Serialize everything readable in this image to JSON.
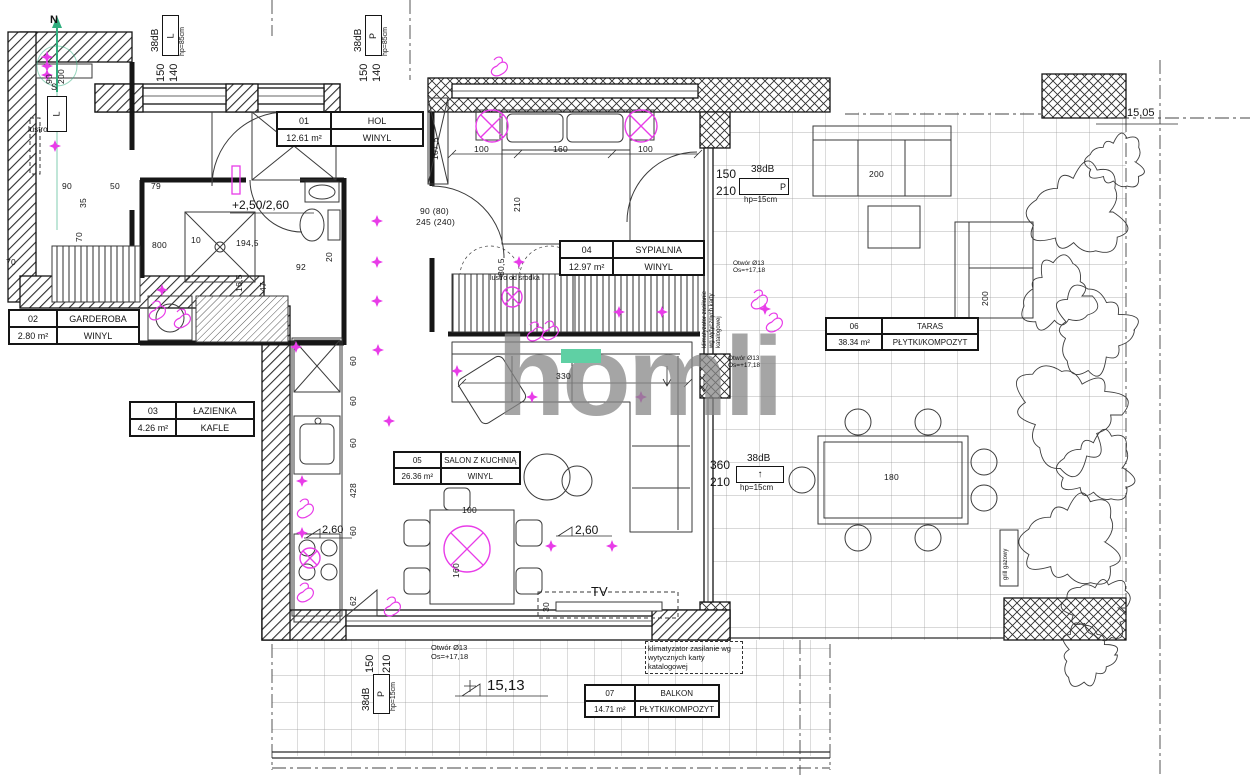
{
  "watermark": {
    "text": "homli",
    "accent_color": "#5fd0a4"
  },
  "rooms": [
    {
      "number": "01",
      "name": "HOL",
      "area": "12.61 m²",
      "floor": "WINYL"
    },
    {
      "number": "02",
      "name": "GARDEROBA",
      "area": "2.80 m²",
      "floor": "WINYL"
    },
    {
      "number": "03",
      "name": "ŁAZIENKA",
      "area": "4.26 m²",
      "floor": "KAFLE"
    },
    {
      "number": "04",
      "name": "SYPIALNIA",
      "area": "12.97 m²",
      "floor": "WINYL"
    },
    {
      "number": "05",
      "name": "SALON Z KUCHNIĄ",
      "area": "26.36 m²",
      "floor": "WINYL"
    },
    {
      "number": "06",
      "name": "TARAS",
      "area": "38.34 m²",
      "floor": "PŁYTKI/KOMPOZYT"
    },
    {
      "number": "07",
      "name": "BALKON",
      "area": "14.71 m²",
      "floor": "PŁYTKI/KOMPOZYT"
    }
  ],
  "windows": [
    {
      "w": "150",
      "h": "140",
      "db": "38dB",
      "tag": "L",
      "hp": "hp=85cm"
    },
    {
      "w": "150",
      "h": "140",
      "db": "38dB",
      "tag": "P",
      "hp": "hp=85cm"
    },
    {
      "w": "150",
      "h": "210",
      "db": "38dB",
      "tag": "P",
      "hp": "hp=15cm"
    },
    {
      "w": "360",
      "h": "210",
      "db": "38dB",
      "tag": "↑",
      "hp": "hp=15cm"
    },
    {
      "w": "150",
      "h": "210",
      "db": "38dB",
      "tag": "P",
      "hp": "hp=15cm"
    }
  ],
  "annotations": {
    "north": "N",
    "south": "S",
    "switch_l": "L",
    "lustro": "lustro",
    "lustro_od_srodka": "lustro od środka",
    "level_bath": "+2,50/2,60",
    "level_kitchen": "2,60",
    "level_salon": "2,60",
    "level_balkon": "15,13",
    "level_taras": "15,05",
    "otwor": "Otwór Ø13",
    "otwor_os": "Os=+17,18",
    "klimatyzator": "klimatyzator zasilanie wg wytycznych karty katalogowej",
    "tv": "TV",
    "grill": "grill gazowy"
  },
  "dimensions": [
    {
      "t": "100",
      "x": 474,
      "y": 144
    },
    {
      "t": "160",
      "x": 553,
      "y": 144
    },
    {
      "t": "100",
      "x": 638,
      "y": 144
    },
    {
      "t": "210",
      "x": 512,
      "y": 212,
      "r": 1
    },
    {
      "t": "80,5",
      "x": 496,
      "y": 276,
      "r": 1
    },
    {
      "t": "107,5",
      "x": 430,
      "y": 160,
      "r": 1
    },
    {
      "t": "90 (80)",
      "x": 420,
      "y": 206
    },
    {
      "t": "245 (240)",
      "x": 416,
      "y": 217
    },
    {
      "t": "330",
      "x": 556,
      "y": 371
    },
    {
      "t": "90",
      "x": 62,
      "y": 181
    },
    {
      "t": "50",
      "x": 110,
      "y": 181
    },
    {
      "t": "79",
      "x": 151,
      "y": 181
    },
    {
      "t": "35",
      "x": 78,
      "y": 208,
      "r": 1
    },
    {
      "t": "70",
      "x": 74,
      "y": 242,
      "r": 1
    },
    {
      "t": "10",
      "x": 191,
      "y": 235
    },
    {
      "t": "194,5",
      "x": 236,
      "y": 238
    },
    {
      "t": "800",
      "x": 152,
      "y": 240
    },
    {
      "t": "16,5",
      "x": 234,
      "y": 292,
      "r": 1
    },
    {
      "t": "47",
      "x": 258,
      "y": 292,
      "r": 1
    },
    {
      "t": "92",
      "x": 296,
      "y": 262
    },
    {
      "t": "20",
      "x": 324,
      "y": 262,
      "r": 1
    },
    {
      "t": "70",
      "x": 6,
      "y": 257
    },
    {
      "t": "60",
      "x": 348,
      "y": 366,
      "r": 1
    },
    {
      "t": "60",
      "x": 348,
      "y": 406,
      "r": 1
    },
    {
      "t": "60",
      "x": 348,
      "y": 448,
      "r": 1
    },
    {
      "t": "428",
      "x": 348,
      "y": 498,
      "r": 1
    },
    {
      "t": "60",
      "x": 348,
      "y": 536,
      "r": 1
    },
    {
      "t": "62",
      "x": 348,
      "y": 606,
      "r": 1
    },
    {
      "t": "160",
      "x": 451,
      "y": 578,
      "r": 1
    },
    {
      "t": "100",
      "x": 462,
      "y": 505
    },
    {
      "t": "30",
      "x": 541,
      "y": 612,
      "r": 1
    },
    {
      "t": "180",
      "x": 884,
      "y": 472
    },
    {
      "t": "200",
      "x": 869,
      "y": 169
    },
    {
      "t": "200",
      "x": 980,
      "y": 306,
      "r": 1
    },
    {
      "t": "90",
      "x": 44,
      "y": 84,
      "r": 1
    },
    {
      "t": "200",
      "x": 56,
      "y": 84,
      "r": 1
    }
  ],
  "plan_marks": {
    "color": "#e83ce8",
    "stars": [
      [
        47,
        57
      ],
      [
        47,
        66
      ],
      [
        47,
        75
      ],
      [
        55,
        146
      ],
      [
        162,
        290
      ],
      [
        296,
        347
      ],
      [
        374,
        136
      ],
      [
        377,
        221
      ],
      [
        377,
        262
      ],
      [
        377,
        301
      ],
      [
        378,
        350
      ],
      [
        457,
        371
      ],
      [
        532,
        397
      ],
      [
        641,
        397
      ],
      [
        519,
        262
      ],
      [
        565,
        262
      ],
      [
        619,
        312
      ],
      [
        662,
        312
      ],
      [
        302,
        481
      ],
      [
        302,
        533
      ],
      [
        551,
        546
      ],
      [
        612,
        546
      ],
      [
        765,
        309
      ],
      [
        389,
        421
      ]
    ],
    "lamps": [
      [
        492,
        126,
        16
      ],
      [
        641,
        126,
        16
      ],
      [
        467,
        549,
        23
      ],
      [
        512,
        297,
        10
      ],
      [
        310,
        558,
        10
      ]
    ],
    "squiggles": [
      [
        303,
        508
      ],
      [
        303,
        592
      ],
      [
        390,
        606
      ],
      [
        533,
        331
      ],
      [
        757,
        299
      ],
      [
        772,
        322
      ],
      [
        155,
        310
      ],
      [
        548,
        330
      ],
      [
        180,
        318
      ],
      [
        497,
        66
      ]
    ]
  }
}
